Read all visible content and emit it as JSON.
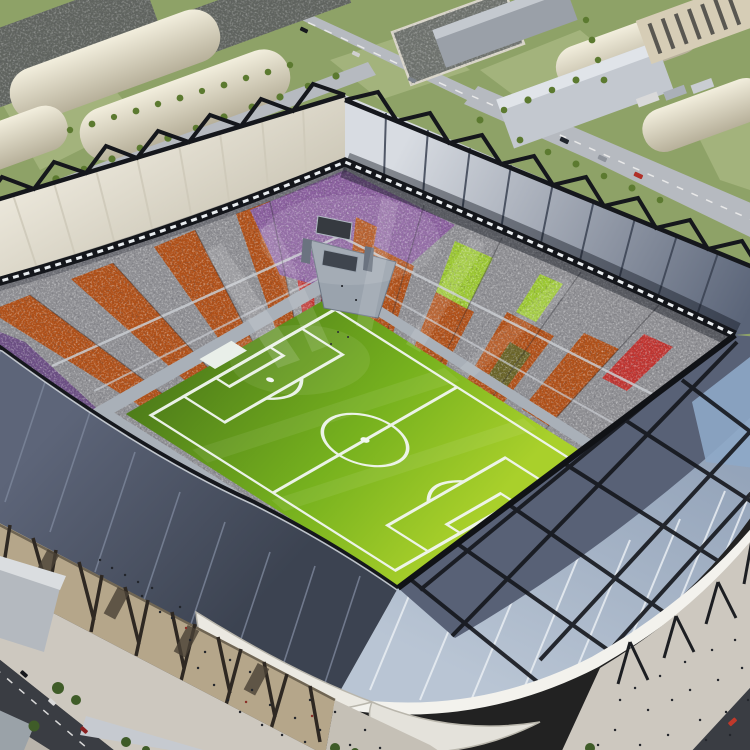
{
  "scene": {
    "title": "Aerial render of a modern football stadium in an industrial district",
    "description": "High-angle three-quarter aerial view. Diamond-oriented stadium with a bright green pitch, crowded stands with colored seating blocks, white fabric roof with black zigzag trusses on the far side, dark slate and pale blue striped roofing on the near side. Surrounded by barrel-roof warehouses, parking lots full of cars, tree-lined roads and pedestrian plazas with people."
  },
  "stadium": {
    "pitch": {
      "surface": "grass",
      "markings": "touchlines, halfway line, centre circle, penalty areas, goal boxes, white goal frame"
    },
    "stands": {
      "style": "speckled crowd",
      "section_colors": [
        "orange",
        "gray",
        "purple",
        "red",
        "maroon",
        "lime-green",
        "olive"
      ],
      "far_corner_feature": "scoreboard platform with two screens"
    },
    "roof": {
      "far_side": "white fabric with black zigzag trusses",
      "right_side": "gray ribbed fabric",
      "near_left": "dark slate panels",
      "near_right": "pale blue panels with white stripes, black cross trusses and white swoosh edge"
    }
  },
  "surroundings": {
    "buildings": [
      "barrel-roof warehouses",
      "flat industrial sheds",
      "tall beige depot with dark windows",
      "small gray offices"
    ],
    "features": [
      "parking lots with cars",
      "tree rows and hedges",
      "diagonal roads with vehicles",
      "pedestrian plazas with people",
      "stadium facade with angled columns"
    ]
  },
  "colors": {
    "grass_base": "#8ea267",
    "grass_light": "#a3b37c",
    "road_light": "#b6bac0",
    "road_dark": "#3a3d43",
    "lot_dark": "#60645f",
    "warehouse_light": "#f2eedd",
    "warehouse_shade": "#b7b09a",
    "shed_gray": "#c3c8cf",
    "shed_dark": "#9aa0a8",
    "depot_beige": "#d6cdb6",
    "tree_green": "#5c7a30",
    "tree_dark": "#3f5c28",
    "roof_white": "#efebdf",
    "roof_white_shade": "#cdc8b8",
    "roof_gray_light": "#d8dce2",
    "roof_gray_dark": "#5a6478",
    "roof_slate": "#5d6579",
    "roof_slate_deep": "#3c4351",
    "roof_blue_mid": "#93a3b9",
    "roof_blue_light": "#b9c5d4",
    "roof_dark_panel": "#586176",
    "lattice_blue": "#8ea8c8",
    "truss_black": "#15171c",
    "rim_black": "#14161b",
    "lattice_white": "#e8ecef",
    "swoosh_white": "#f3f2ed",
    "canopy_white": "#ebe9e2",
    "crowd_base": "#8f8f93",
    "crowd_orange": "#b05018",
    "crowd_purple": "#8a5f9e",
    "crowd_purple_dark": "#6d4f85",
    "crowd_red": "#c03430",
    "crowd_maroon": "#7c2f3a",
    "crowd_lime": "#9cc832",
    "crowd_olive": "#6a6428",
    "pitch_dark": "#4e7d1a",
    "pitch_mid": "#76b11e",
    "pitch_bright": "#a9d02b",
    "line_white": "#f2f7f2",
    "wall_gray": "#a9b0b8",
    "goal_white": "#e9efe9",
    "scoreboard_gray": "#9aa3ad",
    "screen_dark": "#20242b",
    "facade_tan": "#b5a68a",
    "facade_column": "#2e2822",
    "plaza": "#cdc8bf",
    "building_gray": "#b4b9bf",
    "building_top": "#dadde0",
    "people_dark": "#23262c",
    "car_white": "#d9d9d9"
  }
}
